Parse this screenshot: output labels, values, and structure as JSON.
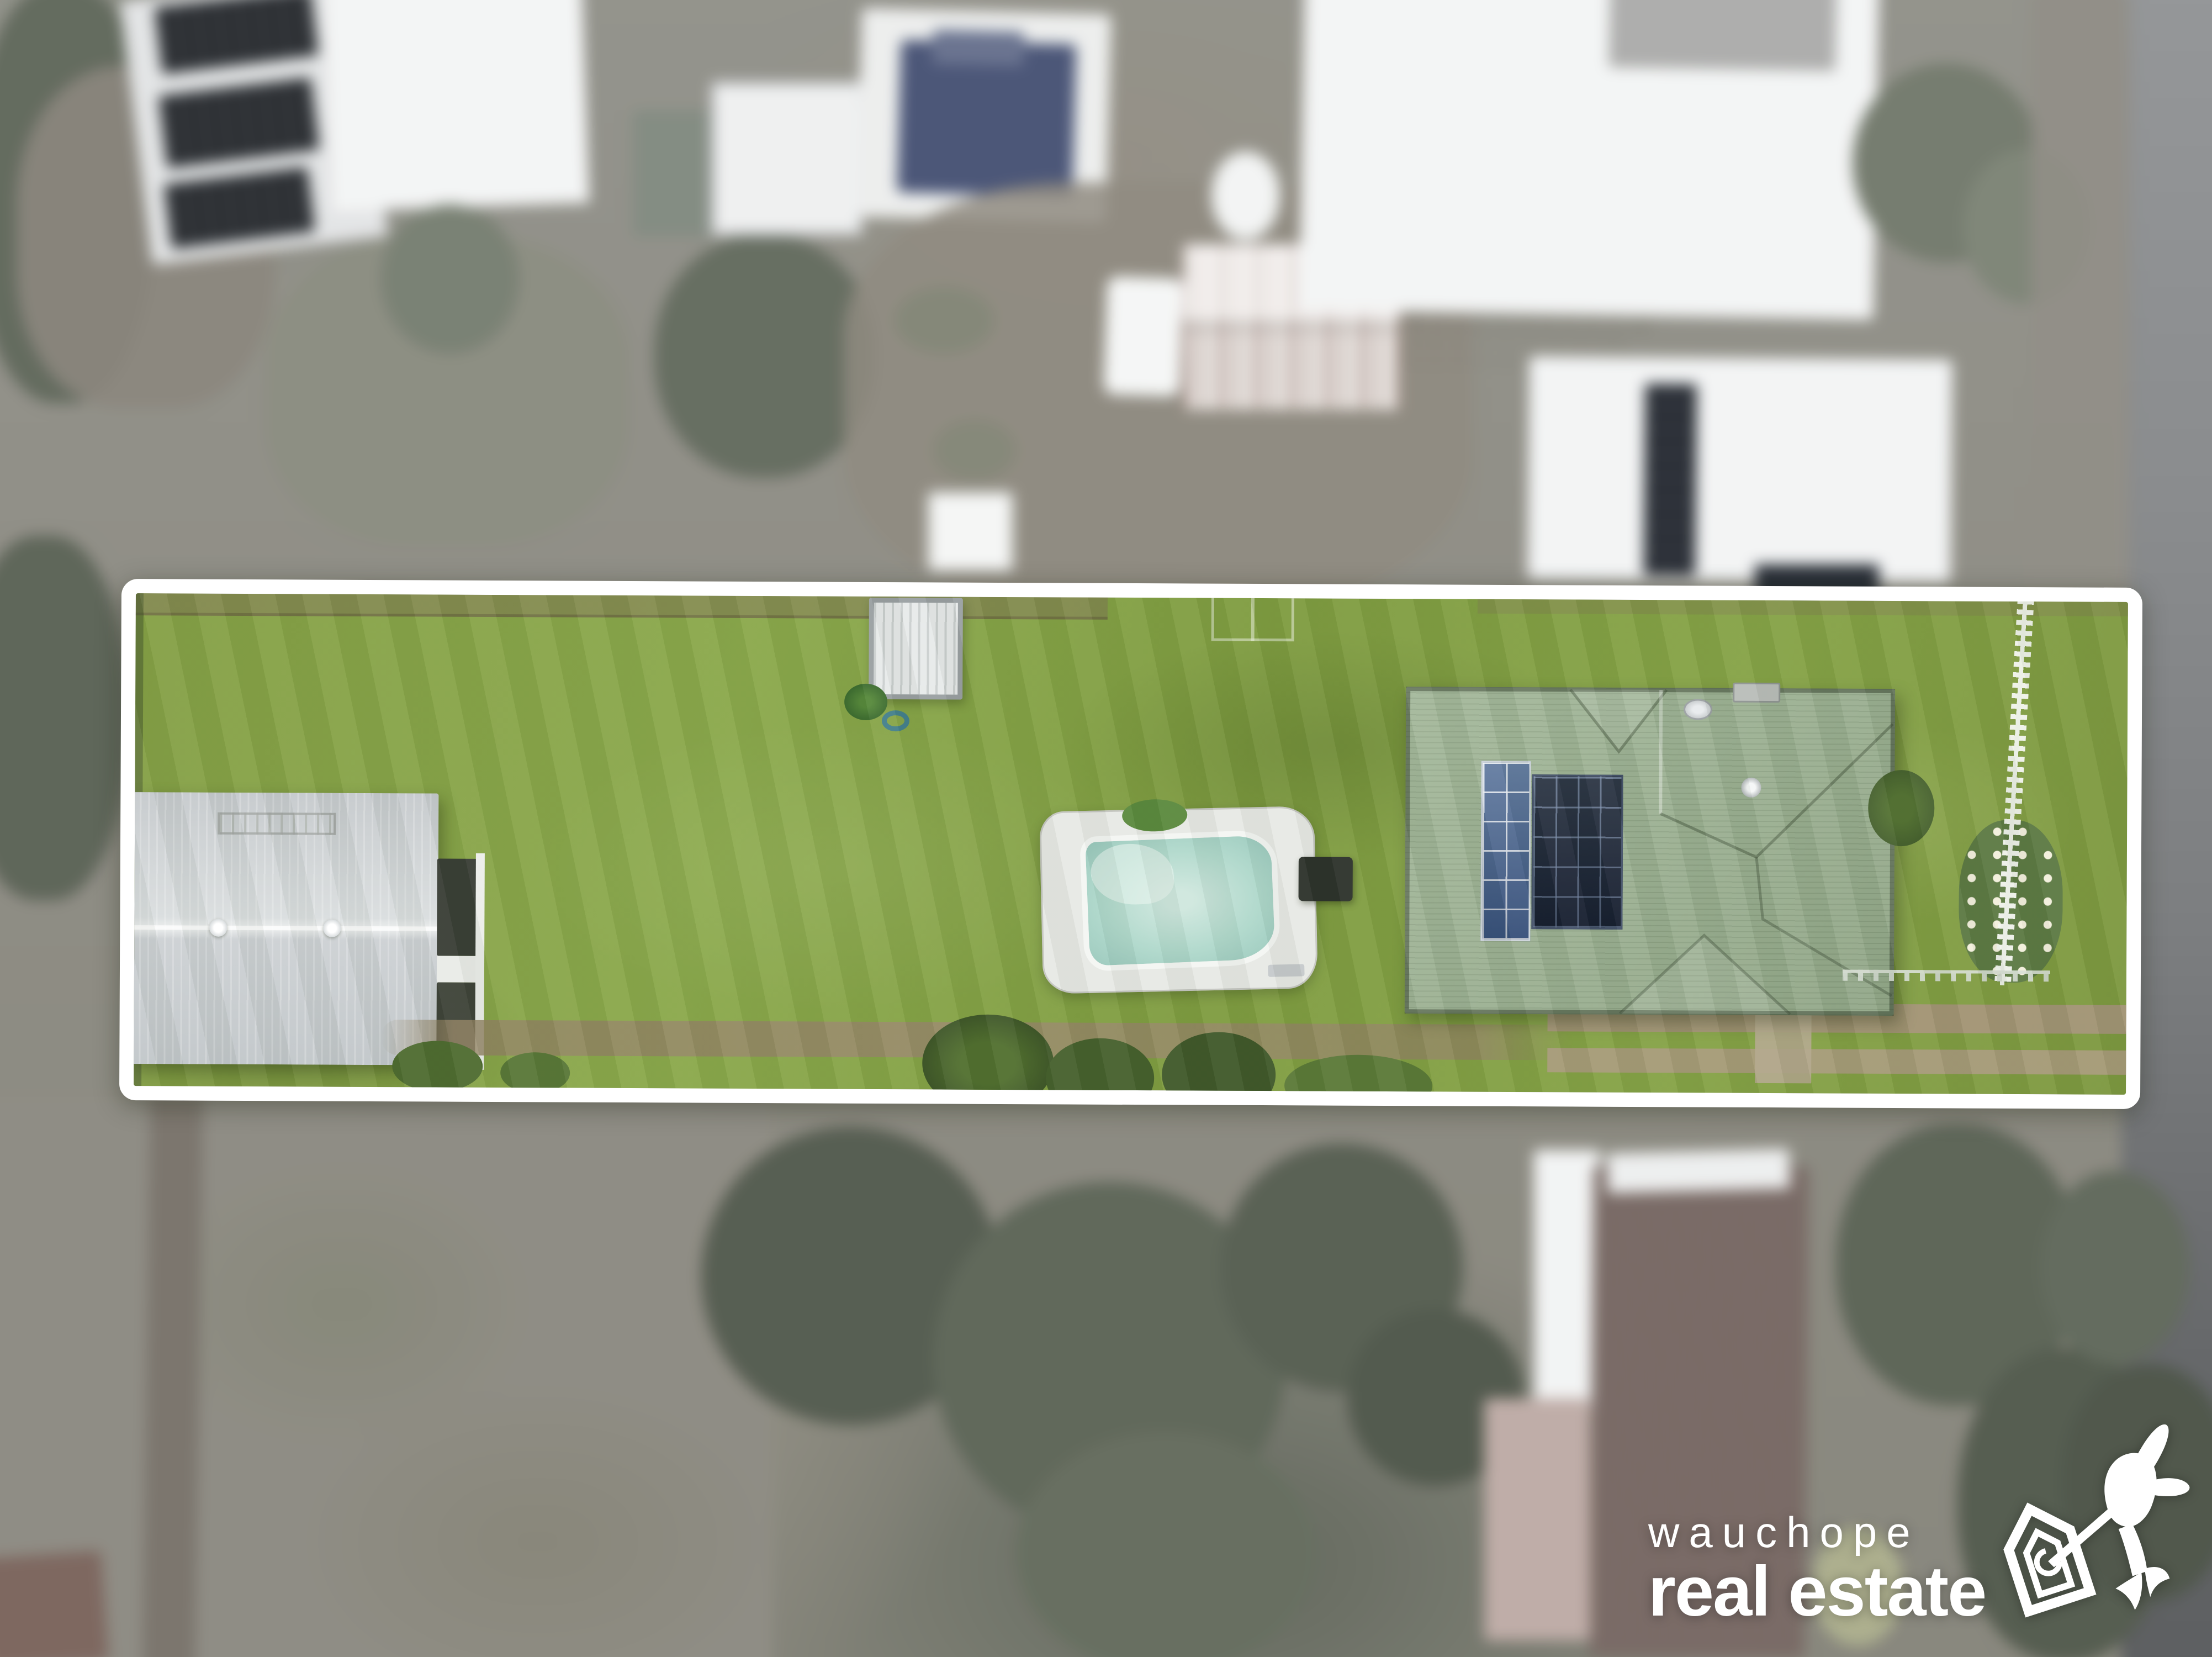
{
  "image": {
    "kind": "real-estate aerial drone photograph",
    "description": "Long residential block highlighted with a white outline; vivid lawn, garage shed, garden shed, in-ground pool, green-roof house with solar panels and picket fence. Surrounding neighbourhood is blurred and desaturated."
  },
  "watermark": {
    "brand_line_1": "wauchope",
    "brand_line_2": "real estate",
    "icon": "house-bird-logo-icon",
    "color": "#ffffff"
  },
  "palette": {
    "lawn": "#84a046",
    "lawn-light": "#90ac4f",
    "lawn-dark": "#6e8c3a",
    "boundary": "#ffffff",
    "house-roof": "#9bb191",
    "solar-dark": "#1d2737",
    "solar-blue": "#44628e",
    "shed-roof": "#ccd0d3",
    "pool-deck": "#e7e9e5",
    "pool-water": "#b2dacd",
    "road": "#75797d",
    "dirt-path": "#97896c",
    "blur-tree": "#515f47",
    "blur-field": "#8d8878",
    "neighbour-roof": "#eef0f0",
    "neighbour-pool": "#3d5292",
    "rust": "#a2604e",
    "watermark": "#ffffff"
  },
  "scene": {
    "property": {
      "label": "highlighted property lot",
      "features": [
        "lawn",
        "garage-shed",
        "roof-vents",
        "carport-bays",
        "clothesline",
        "garden-shed",
        "plant",
        "garden-hose",
        "garden-frame",
        "swimming-pool",
        "pool-pump",
        "dirt-path",
        "gravel-paths",
        "front-path",
        "main-house",
        "solar-array-blue",
        "solar-array-dark",
        "satellite-dish",
        "roof-vent",
        "chimney",
        "dark-bush",
        "rose-bush",
        "picket-fence",
        "front-fence",
        "trees",
        "garden-bushes"
      ]
    },
    "surroundings": {
      "label": "blurred neighbouring properties",
      "features": [
        "neighbour-house-with-solar",
        "neighbour-white-building",
        "green-shed",
        "white-shed",
        "neighbour-blue-pool",
        "dirt-yard",
        "water-tank-dome",
        "trailer",
        "rusty-roof-shed",
        "large-white-roof",
        "dark-gable-roof",
        "east-house-with-solar",
        "gazebo",
        "road",
        "field",
        "dirt-track",
        "trees",
        "brown-roof-house",
        "white-side-building",
        "salmon-deck",
        "yellow-bush"
      ]
    }
  }
}
